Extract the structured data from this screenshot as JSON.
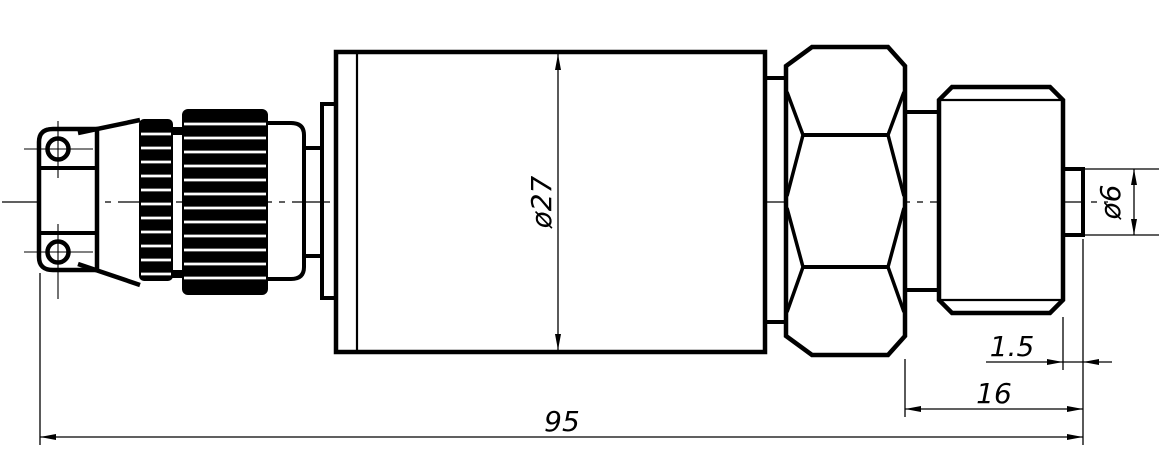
{
  "drawing": {
    "kind": "engineering-outline-drawing",
    "background_color": "#ffffff",
    "line_color": "#000000",
    "labels": {
      "body_diameter": "ø27",
      "tip_diameter": "ø6",
      "tip_length": "1.5",
      "port_length": "16",
      "overall_length": "95"
    }
  }
}
